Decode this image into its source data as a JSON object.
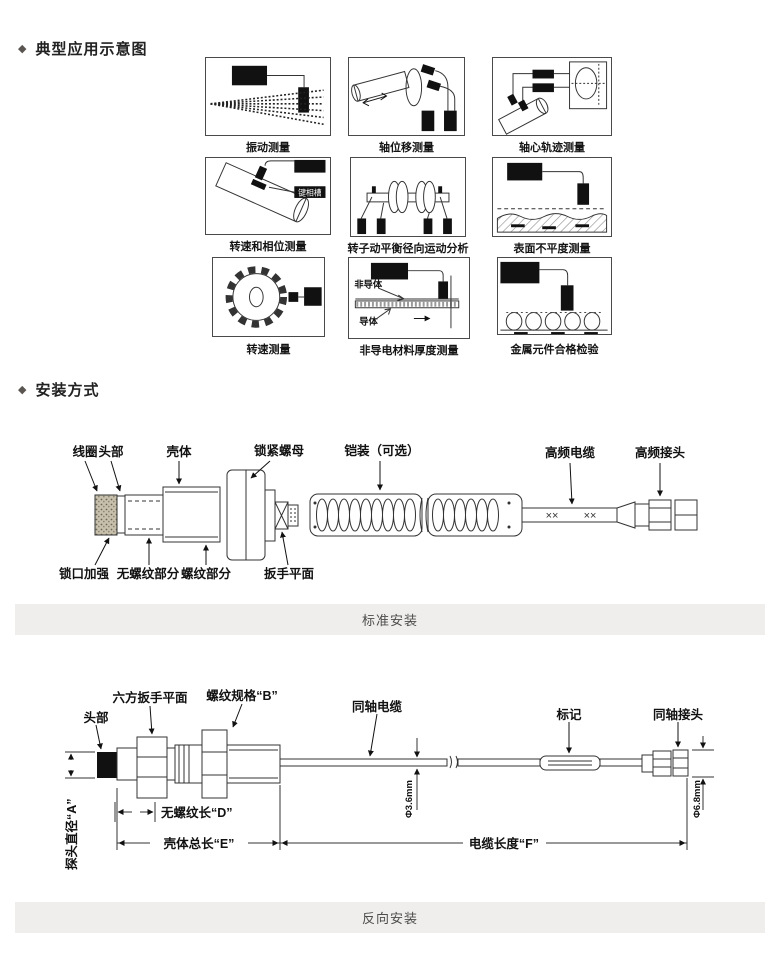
{
  "sections": {
    "applications": {
      "bullet": "◆",
      "title": "典型应用示意图",
      "cells": [
        {
          "caption": "振动测量"
        },
        {
          "caption": "轴位移测量"
        },
        {
          "caption": "轴心轨迹测量"
        },
        {
          "caption": "转速和相位测量",
          "part_label": "键相槽"
        },
        {
          "caption": "转子动平衡径向运动分析"
        },
        {
          "caption": "表面不平度测量"
        },
        {
          "caption": "转速测量"
        },
        {
          "caption": "非导电材料厚度测量",
          "non_conductor": "非导体",
          "conductor": "导体"
        },
        {
          "caption": "金属元件合格检验"
        }
      ]
    },
    "installation": {
      "bullet": "◆",
      "title": "安装方式",
      "standard": {
        "caption": "标准安装",
        "coil": "线圈",
        "head": "头部",
        "housing": "壳体",
        "lock_nut": "锁紧螺母",
        "armor": "铠装（可选）",
        "hf_cable": "高频电缆",
        "hf_connector": "高频接头",
        "lock_reinforce": "锁口加强",
        "unthreaded": "无螺纹部分",
        "threaded": "螺纹部分",
        "wrench_flat": "扳手平面",
        "cable_mark": "××"
      },
      "reverse": {
        "caption": "反向安装",
        "head": "头部",
        "hex_flat": "六方扳手平面",
        "thread_spec": "螺纹规格“B”",
        "coax_cable": "同轴电缆",
        "mark": "标记",
        "coax_connector": "同轴接头",
        "probe_dia": "探头直径“A”",
        "unthreaded_len": "无螺纹长“D”",
        "housing_len": "壳体总长“E”",
        "cable_len": "电缆长度“F”",
        "dia_36": "Φ3.6mm",
        "dia_68": "Φ6.8mm"
      }
    }
  }
}
